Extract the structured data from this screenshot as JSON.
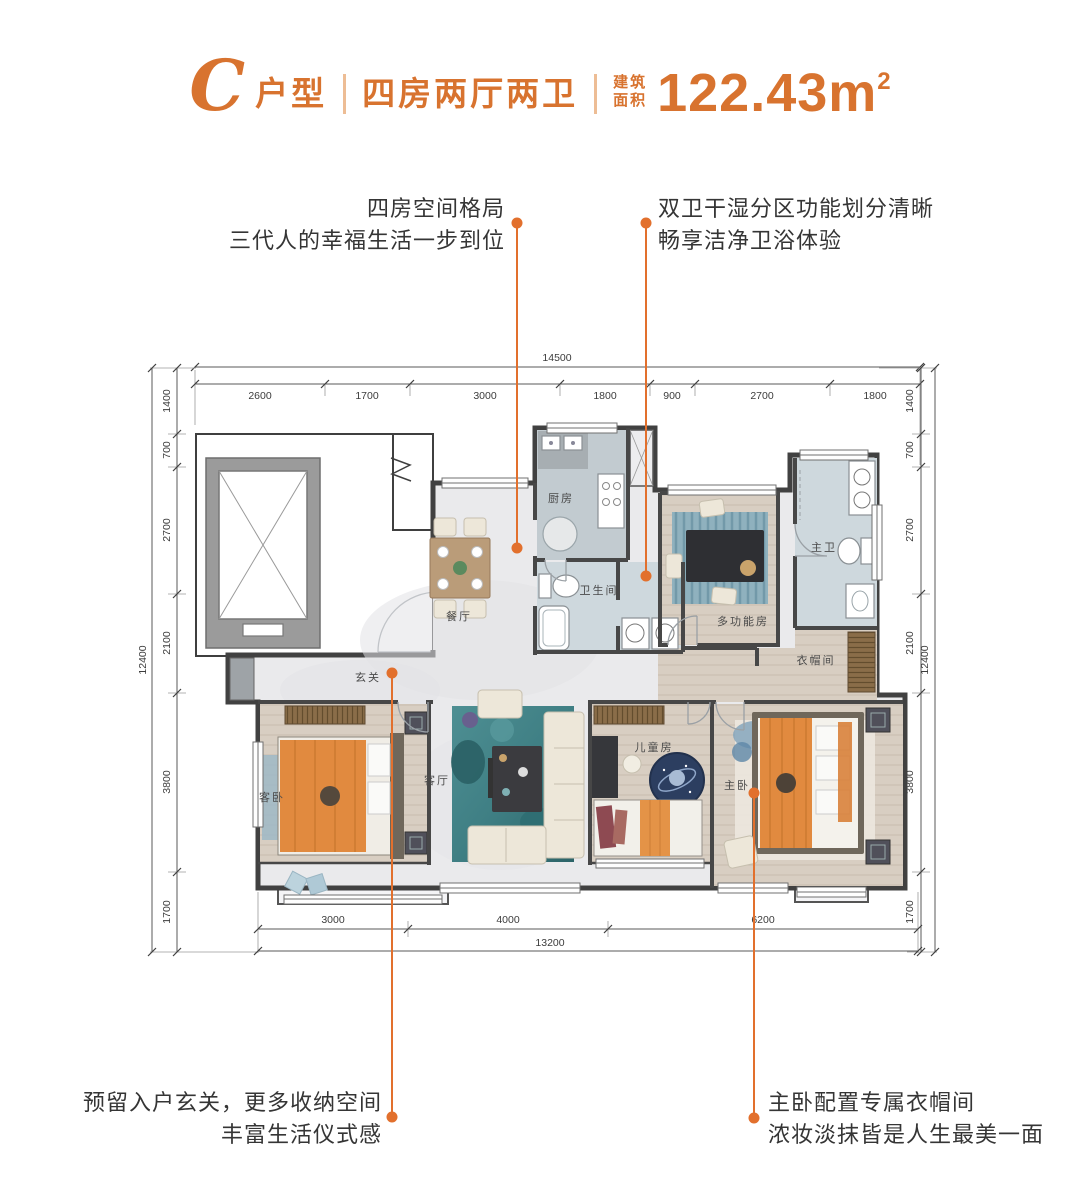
{
  "title": {
    "letter": "C",
    "type_label": "户型",
    "layout_label": "四房两厅两卫",
    "area_label_top": "建筑",
    "area_label_bottom": "面积",
    "area_value": "122.43m",
    "area_sup": "2"
  },
  "callouts": {
    "top_left": {
      "line1": "四房空间格局",
      "line2": "三代人的幸福生活一步到位"
    },
    "top_right": {
      "line1": "双卫干湿分区功能划分清晰",
      "line2": "畅享洁净卫浴体验"
    },
    "bottom_left": {
      "line1": "预留入户玄关，更多收纳空间",
      "line2": "丰富生活仪式感"
    },
    "bottom_right": {
      "line1": "主卧配置专属衣帽间",
      "line2": "浓妆淡抹皆是人生最美一面"
    }
  },
  "dimensions": {
    "top": {
      "total": "14500",
      "segments": [
        "2600",
        "1700",
        "3000",
        "1800",
        "900",
        "2700",
        "1800"
      ]
    },
    "left": {
      "total": "12400",
      "segments": [
        "1400",
        "700",
        "2700",
        "2100",
        "3800",
        "1700"
      ]
    },
    "right": {
      "total": "12400",
      "segments": [
        "1400",
        "700",
        "2700",
        "2100",
        "3800",
        "1700"
      ]
    },
    "bottom": {
      "total": "13200",
      "segments": [
        "3000",
        "4000",
        "6200"
      ]
    }
  },
  "rooms": {
    "kitchen": "厨房",
    "dining": "餐厅",
    "bathroom": "卫生间",
    "multi_room": "多功能房",
    "master_bath": "主卫",
    "cloakroom": "衣帽间",
    "foyer": "玄关",
    "guest_bedroom": "客卧",
    "living_room": "客厅",
    "kids_room": "儿童房",
    "master_bedroom": "主卧"
  },
  "colors": {
    "accent": "#D8732F",
    "callout_orange": "#E2702D",
    "wall": "#474747",
    "marble_floor": "#EAEAEC",
    "wood_floor": "#D8CEC2",
    "bath_floor": "#CED8DD",
    "rug_teal": "#3F7F84",
    "bed_orange": "#E18A3F"
  }
}
